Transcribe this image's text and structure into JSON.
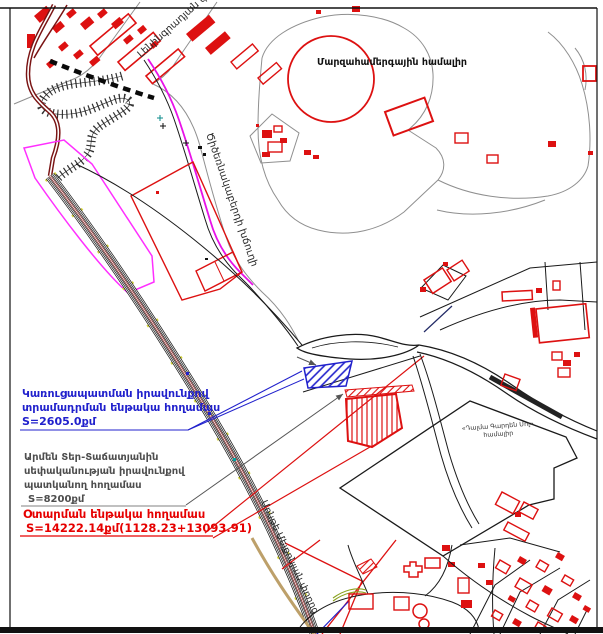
{
  "document": {
    "type": "cadastral-site-plan"
  },
  "streets": {
    "leningradyan": "Լենինգրադյան փողոց",
    "tsitsernakaberd": "Ծիծեռնակաբերդի խճուղի",
    "monte_melkonyan": "Մոնթե Մելքոնյան փողոց"
  },
  "places": {
    "sports_complex": "Մարզահամերգային համալիր",
    "dalma_mall_line1": "«Դալմա Գարդեն Մոլ»",
    "dalma_mall_line2": "համալիր"
  },
  "annotations": {
    "building_right": {
      "line1": "Կառուցապատման իրավունքով",
      "line2": "տրամադրման ենթակա հողամաս",
      "line3": "S=2605.0քմ",
      "color": "#2020cc"
    },
    "ownership": {
      "line1": "Արմեն Տեր-Տաճատյանին",
      "line2": "սեփականության իրավունքով",
      "line3": "պատկանող հողամաս",
      "line4": "S=8200քմ",
      "color": "#4d4d4d"
    },
    "alienation": {
      "line1": "Օտարման ենթակա հողամաս",
      "line2": "S=14222.14քմ(1128.23+13093.91)",
      "color": "#e60000"
    }
  },
  "colors": {
    "building_red": "#dd1111",
    "road_maroon": "#7a1414",
    "highway_magenta": "#e812e8",
    "parcel_magenta": "#ff2fff",
    "hatch_blue": "#2121cc",
    "line_gray": "#8f8f8f",
    "tick_yellow": "#d4d43c",
    "shoulder_tan": "#bda06a"
  }
}
